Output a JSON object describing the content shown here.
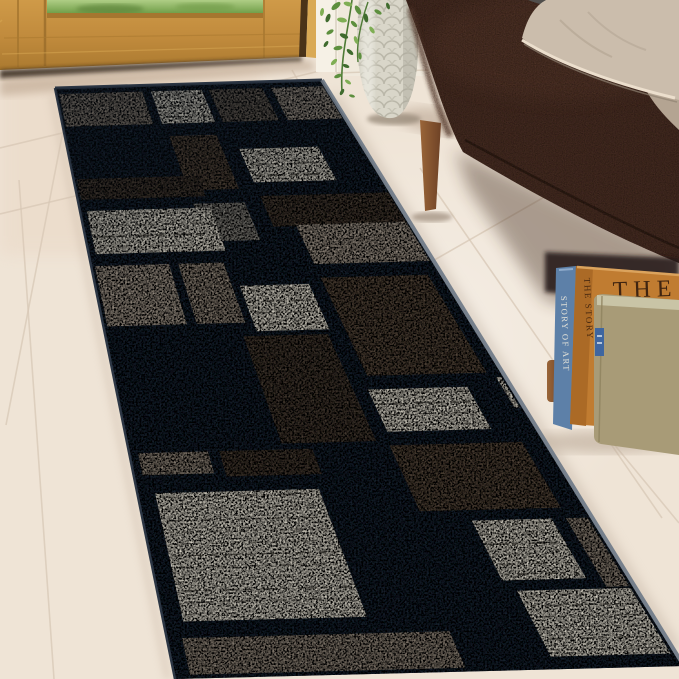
{
  "meta": {
    "description": "Product photo: geometric patchwork runner rug in navy, taupe, brown and cream, laid on a whitewashed tile floor in an entryway beside an oak front door, a silver textured vase with trailing green plant, a dark brown fabric bench with beige pillows, and a stack of books leaning against the wall.",
    "canvas": {
      "w": 679,
      "h": 679
    }
  },
  "scene": {
    "floor": {
      "base": "#efe4d6",
      "tint_near_door": "#e9d5c2",
      "highlight": "#fdf8f1",
      "grout": "#d8c8b6",
      "lines": [
        [
          0,
          148,
          332,
          68
        ],
        [
          0,
          214,
          92,
          192
        ],
        [
          70,
          95,
          6,
          425
        ],
        [
          292,
          70,
          352,
          176
        ],
        [
          19,
          180,
          54,
          679
        ],
        [
          420,
          168,
          662,
          518
        ],
        [
          613,
          443,
          679,
          523
        ],
        [
          300,
          337,
          588,
          172
        ]
      ]
    },
    "door": {
      "oak": "#c08a3c",
      "oak_light": "#d9a954",
      "oak_dark": "#a5762f",
      "jamb_dark": "#4a3318",
      "casing": "#f6f1e6",
      "grass": "#86ad58",
      "grass_dark": "#5c8a3c",
      "grass_light": "#a8c87a",
      "under_shadow": "#2e2318"
    },
    "wall": {
      "color": "#f0e9dc",
      "base_line": "#d9cbb8"
    },
    "vase": {
      "body": "#d9d6c9",
      "texture": "#b5b2a3",
      "highlight": "#efeee6",
      "shade": "#a9a698",
      "shadow": "#c6b4a2"
    },
    "plant": {
      "leaf_tones": [
        "#3f6b2e",
        "#5d8f3e",
        "#7fae54"
      ],
      "stem": "#4e7a35",
      "leaves": [
        [
          336,
          6,
          -40,
          11,
          1
        ],
        [
          348,
          4,
          15,
          9,
          2
        ],
        [
          358,
          10,
          60,
          10,
          1
        ],
        [
          328,
          18,
          -70,
          9,
          0
        ],
        [
          342,
          20,
          10,
          10,
          2
        ],
        [
          354,
          24,
          45,
          8,
          1
        ],
        [
          366,
          18,
          80,
          9,
          0
        ],
        [
          330,
          32,
          -30,
          8,
          1
        ],
        [
          344,
          36,
          25,
          9,
          0
        ],
        [
          356,
          40,
          70,
          8,
          2
        ],
        [
          338,
          48,
          -10,
          9,
          1
        ],
        [
          350,
          52,
          40,
          8,
          0
        ],
        [
          360,
          56,
          85,
          7,
          1
        ],
        [
          334,
          62,
          -45,
          8,
          2
        ],
        [
          346,
          66,
          20,
          7,
          0
        ],
        [
          338,
          76,
          -20,
          8,
          1
        ],
        [
          348,
          82,
          35,
          7,
          2
        ],
        [
          342,
          92,
          -60,
          7,
          0
        ],
        [
          352,
          96,
          15,
          6,
          1
        ],
        [
          372,
          30,
          55,
          8,
          2
        ],
        [
          378,
          12,
          30,
          8,
          1
        ],
        [
          388,
          6,
          70,
          7,
          0
        ],
        [
          322,
          12,
          -80,
          8,
          2
        ],
        [
          326,
          44,
          -55,
          7,
          0
        ]
      ]
    },
    "sofa": {
      "body": "#442b21",
      "top_light": "#5d3e2f",
      "dark": "#2b1a12",
      "piping": "#2c1b14",
      "leg": "#8a5733",
      "leg_dark": "#6e4226"
    },
    "pillows": {
      "front": "#cbbdac",
      "back": "#b4a492",
      "gray": "#504e4c",
      "piping": "#ecdfcd",
      "fold": "#b0a190"
    },
    "books": {
      "blue": {
        "spine": "#5d80a8",
        "dark": "#3d5c80",
        "label": "STORY OF ART",
        "label_color": "#e6e4da"
      },
      "orange": {
        "cover": "#c07c31",
        "spine": "#ab6a26",
        "edge": "#dba35d",
        "cover_title": "THE",
        "title_color": "#3f2410",
        "spine_label": "THE STORY",
        "spine_label_color": "#4a2a10"
      },
      "khaki": {
        "cover": "#a89b77",
        "pages": "#c9c4a6",
        "tag": "#3f66a0"
      },
      "shadow": "#b9a896"
    },
    "rug": {
      "corners": {
        "tl": [
          55,
          88
        ],
        "tr": [
          322,
          80
        ],
        "bl": [
          175,
          679
        ],
        "br": [
          684,
          666
        ]
      },
      "base": "#1c2836",
      "edge_near": "#76808c",
      "edge_far": "#2c3644",
      "streak": "#45413a",
      "streak_light": "#efe8da",
      "palette": {
        "navy": "#203042",
        "taupe": "#93887b",
        "taupe_l": "#a59a8d",
        "gray": "#8a8780",
        "graybrown": "#6e655b",
        "brown": "#5a4c3f",
        "brown_d": "#4b4036",
        "cream": "#e8e3d5"
      },
      "blocks": [
        [
          0.0,
          0.33,
          0.004,
          0.072,
          "taupe"
        ],
        [
          0.34,
          0.55,
          0.004,
          0.072,
          "cream"
        ],
        [
          0.555,
          0.775,
          0.004,
          0.072,
          "graybrown"
        ],
        [
          0.785,
          1.0,
          0.004,
          0.072,
          "taupe_l"
        ],
        [
          0.35,
          0.535,
          0.08,
          0.185,
          "brown"
        ],
        [
          0.35,
          0.535,
          0.195,
          0.272,
          "gray"
        ],
        [
          0.57,
          0.86,
          0.105,
          0.175,
          "cream"
        ],
        [
          0.57,
          1.0,
          0.185,
          0.25,
          "brown_d"
        ],
        [
          0.0,
          0.42,
          0.148,
          0.196,
          "brown_d"
        ],
        [
          0.01,
          0.42,
          0.202,
          0.288,
          "cream"
        ],
        [
          0.0,
          0.24,
          0.295,
          0.41,
          "taupe_l"
        ],
        [
          0.245,
          0.4,
          0.295,
          0.41,
          "taupe"
        ],
        [
          0.64,
          1.0,
          0.235,
          0.315,
          "taupe_l"
        ],
        [
          0.4,
          0.62,
          0.335,
          0.425,
          "cream"
        ],
        [
          0.64,
          0.97,
          0.325,
          0.505,
          "brown"
        ],
        [
          0.36,
          0.61,
          0.42,
          0.615,
          "brown_d"
        ],
        [
          0.965,
          1.0,
          0.5,
          0.565,
          "cream"
        ],
        [
          0.01,
          0.2,
          0.612,
          0.662,
          "taupe"
        ],
        [
          0.205,
          0.45,
          0.612,
          0.668,
          "brown_d"
        ],
        [
          0.625,
          0.9,
          0.515,
          0.6,
          "cream"
        ],
        [
          0.615,
          0.955,
          0.61,
          0.735,
          "brown"
        ],
        [
          0.72,
          0.92,
          0.74,
          0.855,
          "cream"
        ],
        [
          0.93,
          1.0,
          0.74,
          0.87,
          "taupe"
        ],
        [
          0.03,
          0.43,
          0.68,
          0.91,
          "cream"
        ],
        [
          0.02,
          0.585,
          0.925,
          1.0,
          "taupe"
        ],
        [
          0.74,
          1.0,
          0.86,
          0.985,
          "cream"
        ]
      ]
    }
  }
}
